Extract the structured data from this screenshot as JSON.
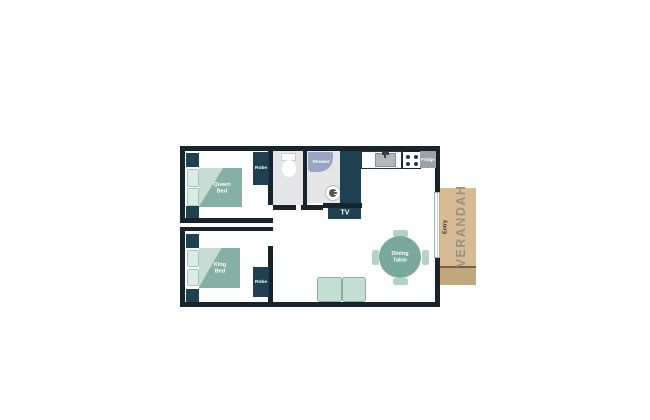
{
  "labels": {
    "queen_bed": "Queen Bed",
    "king_bed": "King Bed",
    "robe": "Robe",
    "shower": "Shower",
    "fridge": "Fridge",
    "tv": "TV",
    "dining_table": "Dining Table",
    "entry": "Entry",
    "verandah": "VERANDAH"
  },
  "colors": {
    "wall": "#17242c",
    "cabinet": "#1e4050",
    "bed": "#85b1a4",
    "bed-fold": "#c7ddd4",
    "pillow": "#dcebe4",
    "pillow-border": "#a3c6b9",
    "bath-floor": "#e6e6e8",
    "shower-unit": "#9aa5c4",
    "sink": "#b3b7bb",
    "fridge": "#99a1aa",
    "table": "#79a99c",
    "chair": "#b5d2c6",
    "couch": "#c3ded2",
    "couch-border": "#86b1a1",
    "verandah": "#d8bb92",
    "verandah-step": "#c3a87f",
    "verandah-line": "#6e6248",
    "verandah-text": "#9b9180",
    "entry-text": "#1f2e38"
  }
}
